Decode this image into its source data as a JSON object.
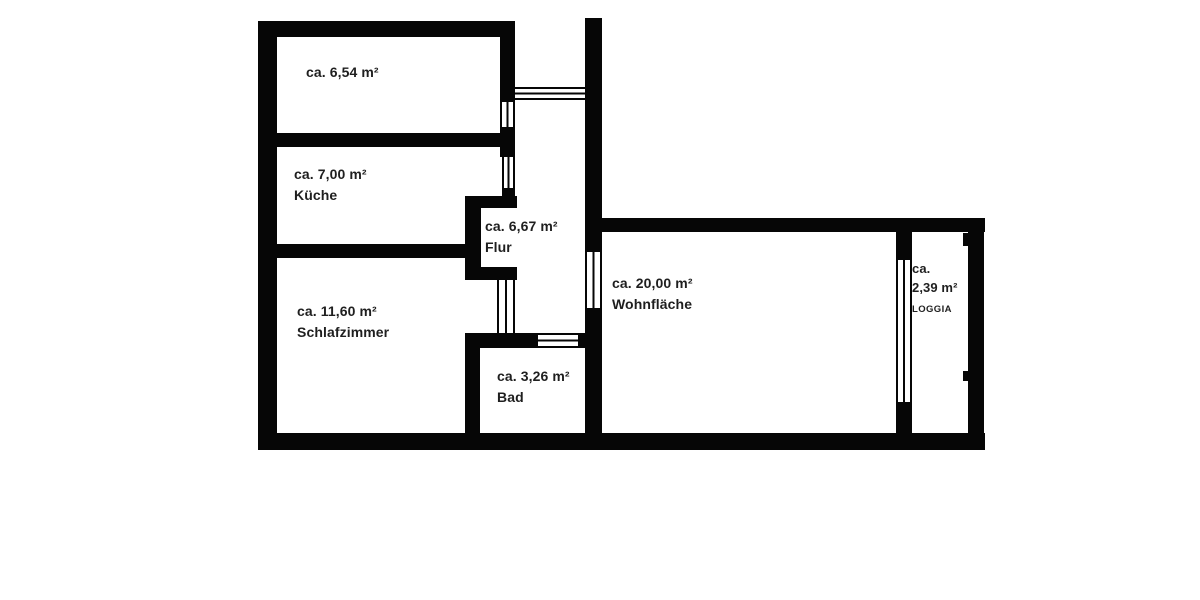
{
  "floorplan": {
    "wall_color": "#060606",
    "background": "#ffffff",
    "text_color": "#1f1f1f",
    "rooms": [
      {
        "area": "ca. 6,54 m²",
        "name": ""
      },
      {
        "area": "ca. 7,00 m²",
        "name": "Küche"
      },
      {
        "area": "ca. 6,67 m²",
        "name": "Flur"
      },
      {
        "area": "ca. 11,60 m²",
        "name": "Schlafzimmer"
      },
      {
        "area": "ca. 20,00 m²",
        "name": "Wohnfläche"
      },
      {
        "area": "ca. 3,26 m²",
        "name": "Bad"
      },
      {
        "area_prefix": "ca.",
        "area": "2,39 m²",
        "name": "LOGGIA"
      }
    ]
  }
}
